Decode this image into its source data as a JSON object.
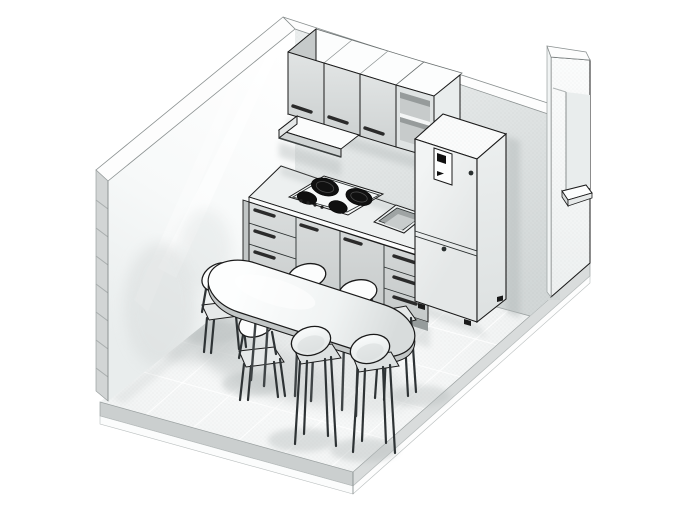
{
  "viewport": {
    "width": 675,
    "height": 506,
    "background": "#ffffff"
  },
  "palette": {
    "background": "#ffffff",
    "outline": "#1a1a1a",
    "wall_top": "#fdfdfd",
    "wall_interior_light": "#ffffff",
    "wall_interior_shade": "#eef1f1",
    "floor_light": "#fafbfb",
    "floor_shade": "#e9eded",
    "tile_line": "#ffffff",
    "slab_side": "#cbcfcf",
    "cabinet_door": "#d8dbdb",
    "cabinet_top": "#fcfdfd",
    "handle": "#2b2b2b",
    "burner": "#101010",
    "toe_kick": "#969c9c",
    "fridge_body": "#eef0f0",
    "shadow": "#b7bdbd"
  },
  "counts": {
    "chairs": 6,
    "cooktop_burners": 4,
    "upper_cabinet_doors": 3,
    "base_cabinet_units": 4,
    "base_cabinet_drawers": 6,
    "open_shelf_levels": 2,
    "table_legs": 6
  },
  "objects": {
    "scene": "kitchen-room-isometric-view",
    "floor": "tiled floor slab",
    "left_wall": "left section-cut wall",
    "back_wall": "back wall",
    "right_wall": "right wall with window sill",
    "upper_cabinets": "upper wall cabinets",
    "open_shelf": "open shelf unit",
    "range_hood": "range hood",
    "countertop": "countertop",
    "cooktop": "four-burner cooktop",
    "base_cabinets": "base cabinets with drawers",
    "sink": "inset kitchen sink",
    "refrigerator": "refrigerator with top freezer",
    "dining_table": "oval dining table",
    "chairs": [
      "chair back-left",
      "chair left",
      "chair behind table",
      "chair right",
      "chair front-left",
      "chair front-right"
    ]
  }
}
